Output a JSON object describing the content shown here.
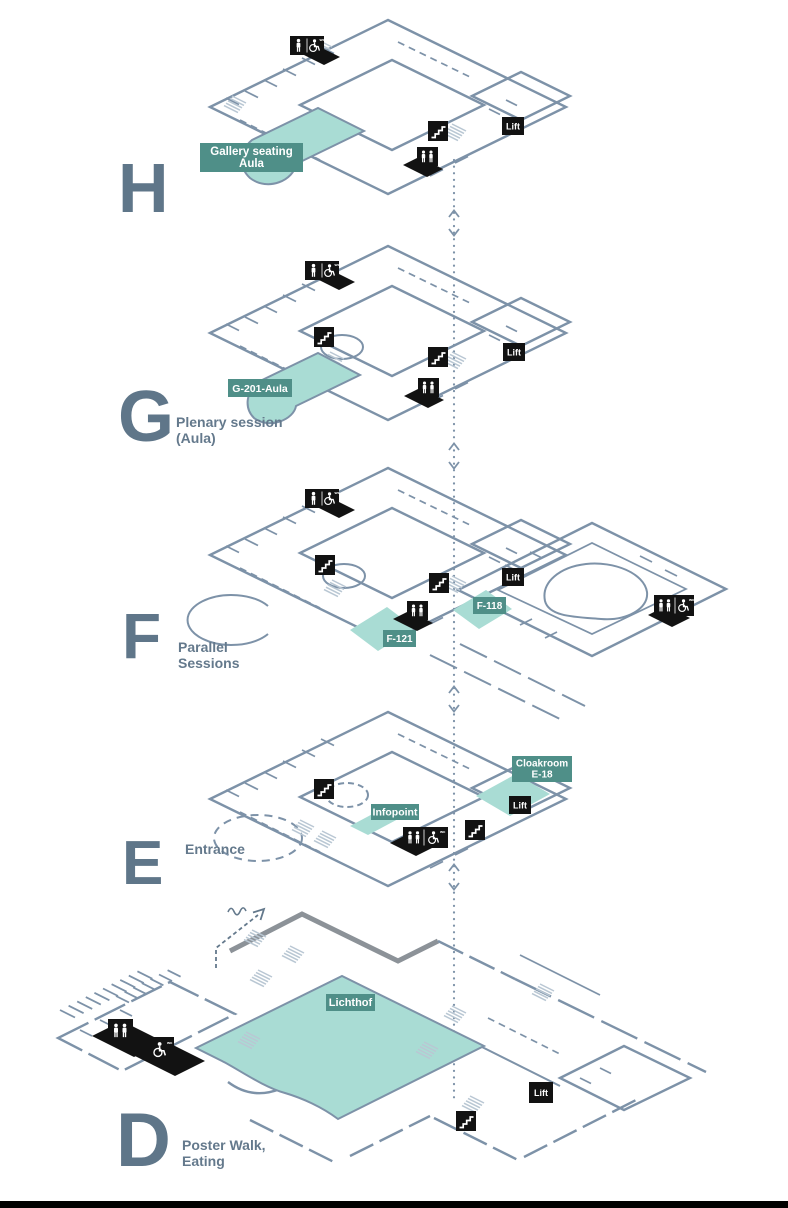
{
  "colors": {
    "wall_line": "#7d92a8",
    "text_slate": "#5f7689",
    "room_fill_teal": "#a9dcd4",
    "label_bg_teal": "#4f8f88",
    "icon_bg_black": "#121212",
    "icon_glyph_white": "#ffffff",
    "stair_tread": "#b9c7d3",
    "thick_wall_gray": "#8c9298",
    "bottom_border": "#000000"
  },
  "icon_text": {
    "wc_small": "wc"
  },
  "connector": {
    "type": "dotted-vertical-line-with-up-down-chevrons"
  },
  "floors": [
    {
      "letter": "H",
      "description_lines": [],
      "lift_label": "Lift",
      "rooms": [
        {
          "name": "gallery-seating-aula",
          "label_lines": [
            "Gallery seating",
            "Aula"
          ]
        }
      ],
      "facility_icons": [
        "wc-icon",
        "accessible-wc-icon",
        "stairs-icon",
        "wc-icon",
        "lift-label"
      ]
    },
    {
      "letter": "G",
      "description_lines": [
        "Plenary session",
        "(Aula)"
      ],
      "lift_label": "Lift",
      "rooms": [
        {
          "name": "g-201-aula",
          "label_lines": [
            "G-201-Aula"
          ]
        }
      ],
      "facility_icons": [
        "wc-icon",
        "accessible-wc-icon",
        "stairs-icon",
        "stairs-icon",
        "wc-icon",
        "lift-label"
      ]
    },
    {
      "letter": "F",
      "description_lines": [
        "Parallel",
        "Sessions"
      ],
      "lift_label": "Lift",
      "rooms": [
        {
          "name": "f-121",
          "label_lines": [
            "F-121"
          ]
        },
        {
          "name": "f-118",
          "label_lines": [
            "F-118"
          ]
        }
      ],
      "facility_icons": [
        "wc-icon",
        "accessible-wc-icon",
        "stairs-icon",
        "stairs-icon",
        "wc-icon",
        "accessible-wc-icon",
        "lift-label"
      ]
    },
    {
      "letter": "E",
      "description_lines": [
        "Entrance"
      ],
      "lift_label": "Lift",
      "rooms": [
        {
          "name": "cloakroom-e-18",
          "label_lines": [
            "Cloakroom",
            "E-18"
          ]
        },
        {
          "name": "infopoint",
          "label_lines": [
            "Infopoint"
          ]
        }
      ],
      "facility_icons": [
        "stairs-icon",
        "wc-icon",
        "accessible-wc-icon",
        "stairs-icon",
        "lift-label"
      ]
    },
    {
      "letter": "D",
      "description_lines": [
        "Poster Walk,",
        "Eating"
      ],
      "lift_label": "Lift",
      "rooms": [
        {
          "name": "lichthof",
          "label_lines": [
            "Lichthof"
          ]
        }
      ],
      "facility_icons": [
        "wc-icon",
        "accessible-wc-icon",
        "stairs-icon",
        "lift-label"
      ]
    }
  ]
}
